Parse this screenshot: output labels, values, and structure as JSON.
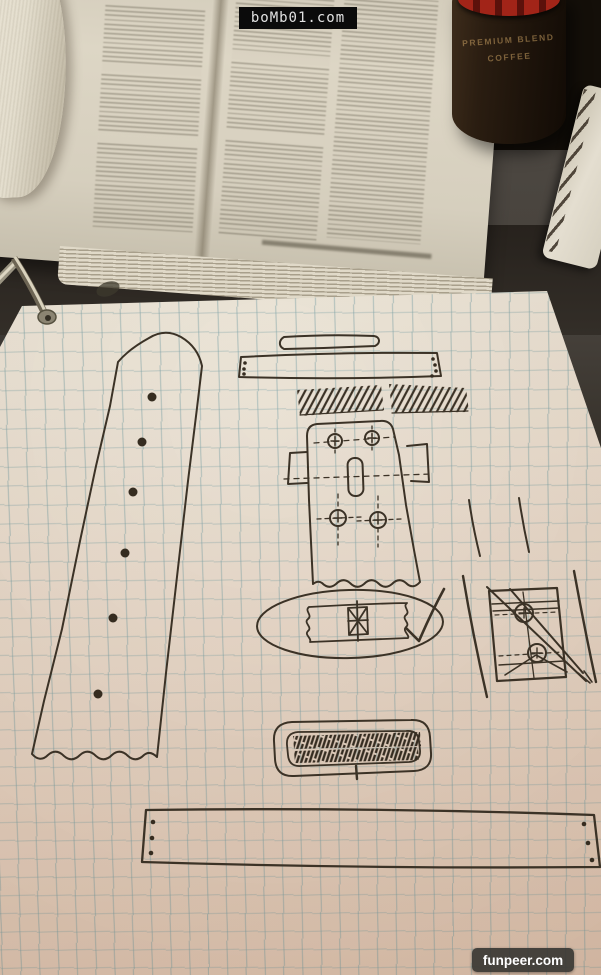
{
  "watermarks": {
    "top_label": "boMb01.com",
    "bottom_label": "funpeer.com"
  },
  "coffee_can": {
    "line1": "PREMIUM BLEND",
    "line2": "COFFEE"
  },
  "colors": {
    "pen": "#3b3226",
    "grid_line": "#6c989e",
    "paper_top": "#efe9dd",
    "paper_bottom": "#d8c0ad",
    "desk": "#3b3733",
    "can_red": "#a22418",
    "watermark_bg": "#0b0b0b"
  }
}
